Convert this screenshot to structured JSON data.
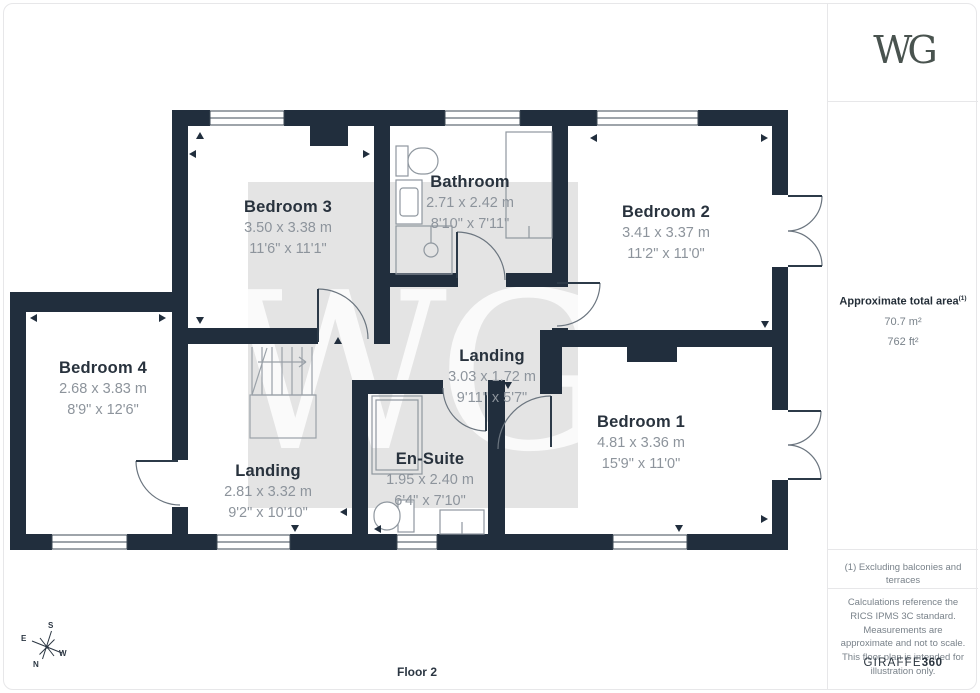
{
  "plan": {
    "floor_label": "Floor 2",
    "watermark": "WG",
    "rooms": [
      {
        "name": "Bedroom 3",
        "metric": "3.50 x 3.38 m",
        "imperial": "11'6\" x 11'1\""
      },
      {
        "name": "Bathroom",
        "metric": "2.71 x 2.42 m",
        "imperial": "8'10\" x 7'11\""
      },
      {
        "name": "Bedroom 2",
        "metric": "3.41 x 3.37 m",
        "imperial": "11'2\" x 11'0\""
      },
      {
        "name": "Bedroom 4",
        "metric": "2.68 x 3.83 m",
        "imperial": "8'9\" x 12'6\""
      },
      {
        "name": "Landing",
        "metric": "3.03 x 1.72 m",
        "imperial": "9'11\" x 5'7\""
      },
      {
        "name": "Landing",
        "metric": "2.81 x 3.32 m",
        "imperial": "9'2\" x 10'10\""
      },
      {
        "name": "En-Suite",
        "metric": "1.95 x 2.40 m",
        "imperial": "6'4\" x 7'10\""
      },
      {
        "name": "Bedroom 1",
        "metric": "4.81 x 3.36 m",
        "imperial": "15'9\" x 11'0\""
      }
    ],
    "compass": {
      "n": "N",
      "s": "S",
      "e": "E",
      "w": "W"
    }
  },
  "sidebar": {
    "logo": "WG",
    "area_title": "Approximate total area",
    "area_footnote_marker": "(1)",
    "area_m2": "70.7 m²",
    "area_ft2": "762 ft²",
    "footnote": "(1) Excluding balconies and terraces",
    "disclaimer": "Calculations reference the RICS IPMS 3C standard. Measurements are approximate and not to scale. This floor plan is intended for illustration only.",
    "brand_giraffe": "GIRAFFE",
    "brand_360": "360"
  },
  "colors": {
    "wall": "#212e3d",
    "shade": "#e4e4e4",
    "fixture_line": "#8f979f",
    "door_arc": "#6b757f",
    "room_name_text": "#28323d",
    "dimension_text": "#8d949c"
  }
}
